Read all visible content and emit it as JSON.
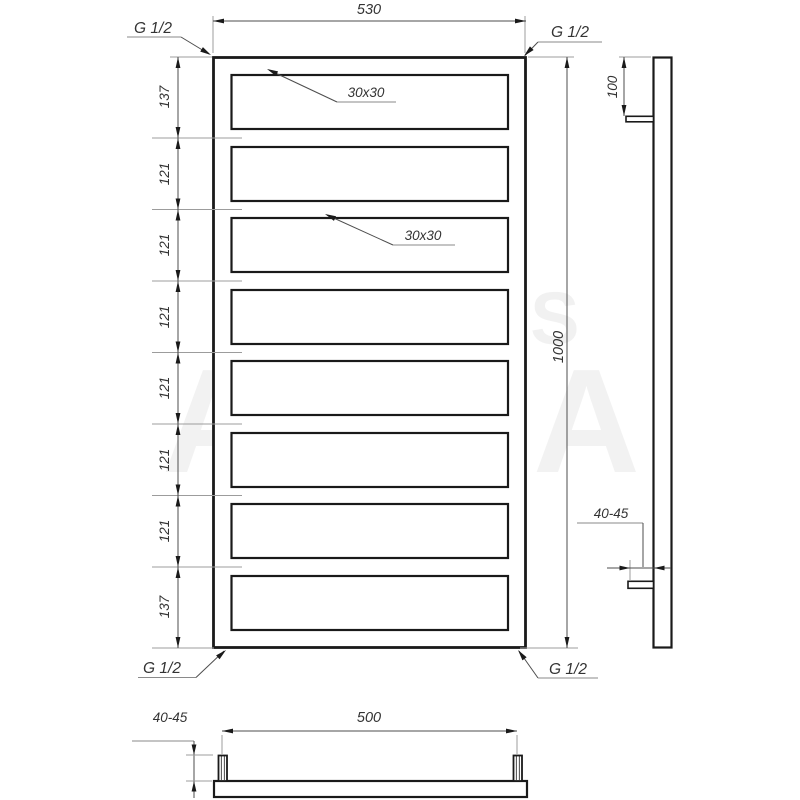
{
  "front_view": {
    "overall_width": "530",
    "overall_height": "1000",
    "segments": [
      "137",
      "121",
      "121",
      "121",
      "121",
      "121",
      "121",
      "137"
    ],
    "profile_label_1": "30x30",
    "profile_label_2": "30x30",
    "thread_top_left": "G 1/2",
    "thread_top_right": "G 1/2",
    "thread_bottom_left": "G 1/2",
    "thread_bottom_right": "G 1/2"
  },
  "side_view": {
    "top_connection_offset": "100",
    "wall_clearance": "40-45"
  },
  "bottom_view": {
    "connection_spacing": "500",
    "wall_clearance": "40-45"
  },
  "watermark": {
    "line1": "GENESIS",
    "line2": "AQUA"
  },
  "colors": {
    "line": "#1a1a1a",
    "dimension": "#4d4d4d",
    "extension": "#9c9c9c",
    "text": "#333333",
    "background": "#ffffff"
  }
}
